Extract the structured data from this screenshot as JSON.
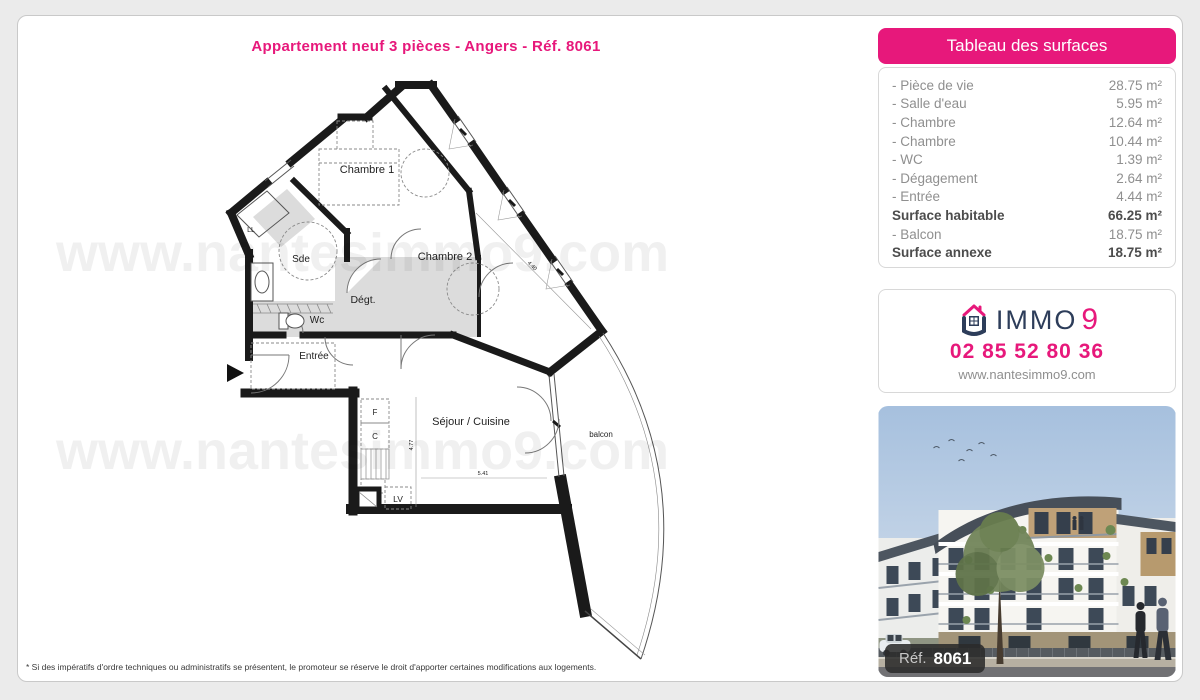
{
  "page": {
    "title": "Appartement neuf 3 pièces - Angers - Réf. 8061",
    "footnote": "* Si des impératifs d'ordre techniques ou administratifs se présentent, le promoteur se réserve le droit d'apporter certaines modifications aux logements."
  },
  "surfaces": {
    "title": "Tableau des surfaces",
    "rows": [
      {
        "label": "- Pièce de vie",
        "value": "28.75 m²"
      },
      {
        "label": "- Salle d'eau",
        "value": "5.95 m²"
      },
      {
        "label": "- Chambre",
        "value": "12.64 m²"
      },
      {
        "label": "- Chambre",
        "value": "10.44 m²"
      },
      {
        "label": "- WC",
        "value": "1.39 m²"
      },
      {
        "label": "- Dégagement",
        "value": "2.64 m²"
      },
      {
        "label": "- Entrée",
        "value": "4.44 m²"
      },
      {
        "label": "Surface habitable",
        "value": "66.25 m²"
      },
      {
        "label": "- Balcon",
        "value": "18.75 m²"
      },
      {
        "label": "Surface annexe",
        "value": "18.75 m²"
      }
    ]
  },
  "agency": {
    "brand_immo": "IMMO",
    "brand_nine": "9",
    "phone": "02 85 52 80 36",
    "website": "www.nantesimmo9.com"
  },
  "photo": {
    "ref_label": "Réf.",
    "ref_number": "8061"
  },
  "plan": {
    "watermark": "www.nantesimmo9.com",
    "labels": {
      "chambre1": "Chambre 1",
      "chambre2": "Chambre 2",
      "sde": "Sde",
      "degt": "Dégt.",
      "wc": "Wc",
      "ll": "LL",
      "entree": "Entrée",
      "f": "F",
      "c": "C",
      "lv": "LV",
      "sejour": "Séjour / Cuisine",
      "balcon": "balcon"
    },
    "dims": {
      "h": "4.77",
      "w": "5.41",
      "d": "4.40"
    }
  },
  "colors": {
    "accent_pink": "#e7187b",
    "logo_navy": "#2d3d5a",
    "wall_black": "#1a1a1a",
    "shade_gray": "#dcdcdc"
  }
}
